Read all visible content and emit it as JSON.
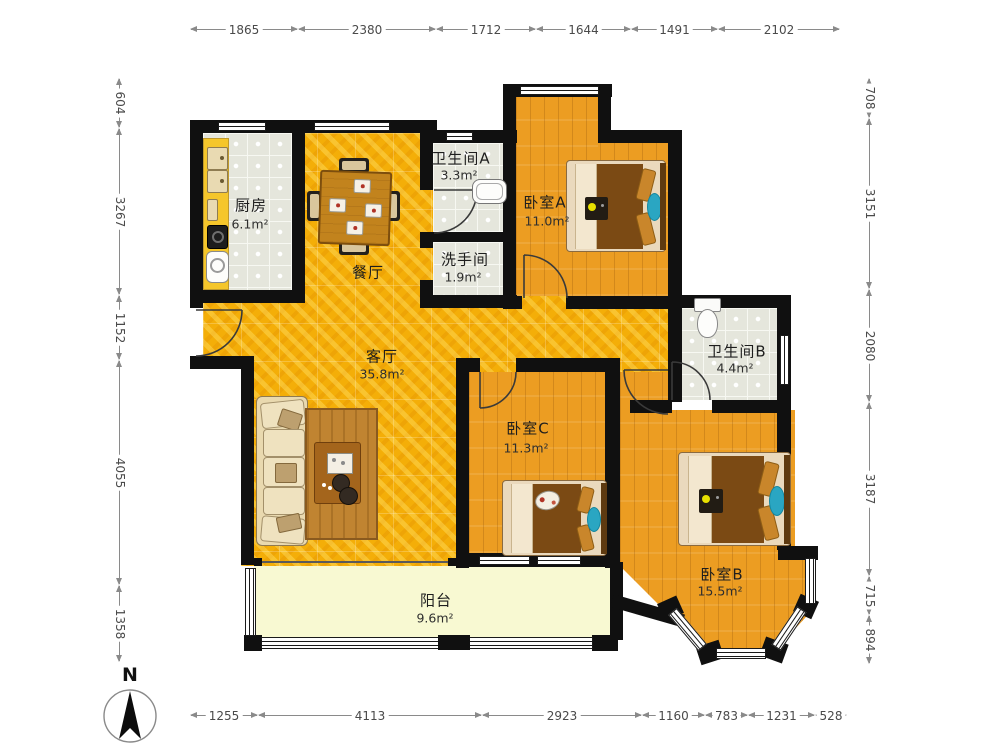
{
  "dimensions": {
    "top": [
      "1865",
      "2380",
      "1712",
      "1644",
      "1491",
      "2102"
    ],
    "left": [
      "604",
      "3267",
      "1152",
      "4055",
      "1358"
    ],
    "right": [
      "708",
      "3151",
      "2080",
      "3187",
      "715",
      "894"
    ],
    "bottom": [
      "1255",
      "4113",
      "2923",
      "1160",
      "783",
      "1231",
      "528"
    ]
  },
  "rooms": [
    {
      "name": "厨房",
      "area": "6.1m²"
    },
    {
      "name": "餐厅",
      "area": ""
    },
    {
      "name": "卫生间A",
      "area": "3.3m²"
    },
    {
      "name": "洗手间",
      "area": "1.9m²"
    },
    {
      "name": "卧室A",
      "area": "11.0m²"
    },
    {
      "name": "客厅",
      "area": "35.8m²"
    },
    {
      "name": "卫生间B",
      "area": "4.4m²"
    },
    {
      "name": "卧室C",
      "area": "11.3m²"
    },
    {
      "name": "卧室B",
      "area": "15.5m²"
    },
    {
      "name": "阳台",
      "area": "9.6m²"
    }
  ],
  "compass": {
    "north_label": "N"
  },
  "colors": {
    "wall": "#101010",
    "floor_public": "#F4AE08",
    "floor_bedroom": "#EC9D22",
    "floor_tile": "#E5E6DC",
    "floor_balcony": "#F8F9D2",
    "counter": "#F5C62B",
    "blanket": "#7B4A14",
    "pillow_accent": "#2AA6C2",
    "dimension_text": "#4A4A4A"
  }
}
